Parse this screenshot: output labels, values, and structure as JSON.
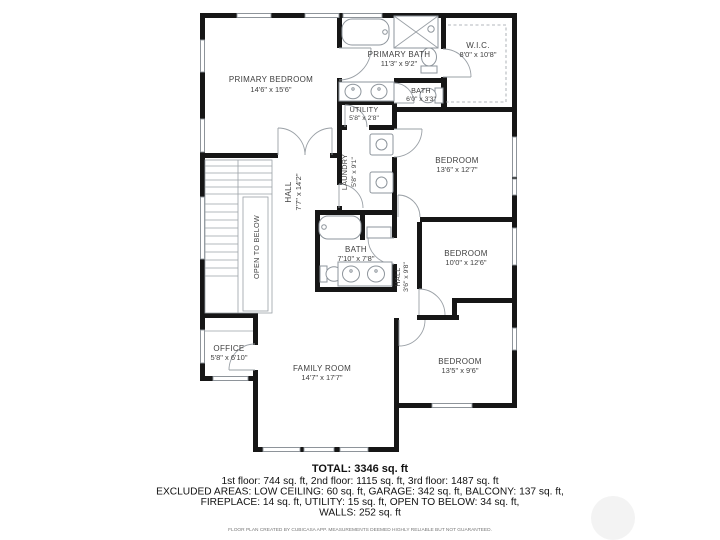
{
  "plan": {
    "wall_color": "#161616",
    "line_color": "#9aa0a6",
    "text_color": "#3f3f3f",
    "rooms": [
      {
        "id": "primary-bedroom",
        "name": "PRIMARY BEDROOM",
        "dims": "14'6\" x 15'6\""
      },
      {
        "id": "primary-bath",
        "name": "PRIMARY BATH",
        "dims": "11'3\" x 9'2\""
      },
      {
        "id": "wic",
        "name": "W.I.C.",
        "dims": "8'0\" x 10'8\""
      },
      {
        "id": "bath-upper",
        "name": "BATH",
        "dims": "6'0\" x 3'3\""
      },
      {
        "id": "utility",
        "name": "UTILITY",
        "dims": "5'8\" x 2'8\""
      },
      {
        "id": "laundry",
        "name": "LAUNDRY",
        "dims": "5'8\" x 9'1\""
      },
      {
        "id": "bedroom-ne",
        "name": "BEDROOM",
        "dims": "13'6\" x 12'7\""
      },
      {
        "id": "hall",
        "name": "HALL",
        "dims": "7'7\" x 14'2\""
      },
      {
        "id": "open-to-below",
        "name": "OPEN TO BELOW",
        "dims": ""
      },
      {
        "id": "bath-middle",
        "name": "BATH",
        "dims": "7'10\" x 7'8\""
      },
      {
        "id": "hall-small",
        "name": "HALL",
        "dims": "3'6\" x 9'8\""
      },
      {
        "id": "bedroom-e",
        "name": "BEDROOM",
        "dims": "10'0\" x 12'6\""
      },
      {
        "id": "bedroom-se",
        "name": "BEDROOM",
        "dims": "13'5\" x 9'6\""
      },
      {
        "id": "office",
        "name": "OFFICE",
        "dims": "5'8\" x 6'10\""
      },
      {
        "id": "family-room",
        "name": "FAMILY ROOM",
        "dims": "14'7\" x 17'7\""
      }
    ],
    "icons": [
      "bathtub-icon",
      "shower-icon",
      "toilet-icon",
      "sink-icon",
      "washer-icon",
      "dryer-icon",
      "stairs-icon"
    ]
  },
  "footer": {
    "total": "TOTAL: 3346 sq. ft",
    "floors": "1st floor: 744 sq. ft, 2nd floor: 1115 sq. ft, 3rd floor: 1487 sq. ft",
    "excluded1": "EXCLUDED AREAS: LOW CEILING: 60 sq. ft, GARAGE: 342 sq. ft, BALCONY: 137 sq. ft,",
    "excluded2": "FIREPLACE: 14 sq. ft, UTILITY: 15 sq. ft, OPEN TO BELOW: 34 sq. ft,",
    "excluded3": "WALLS: 252 sq. ft",
    "disclaimer": "FLOOR PLAN CREATED BY CUBICASA APP. MEASUREMENTS DEEMED HIGHLY RELIABLE BUT NOT GUARANTEED."
  }
}
